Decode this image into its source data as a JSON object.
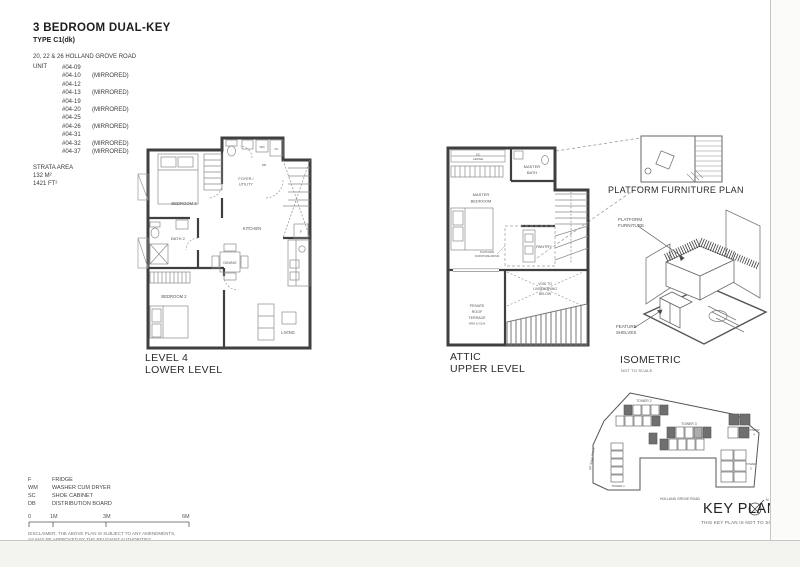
{
  "header": {
    "title": "3 BEDROOM DUAL-KEY",
    "type": "TYPE C1(dk)",
    "address": "20, 22 & 26 HOLLAND GROVE ROAD",
    "unit_label": "UNIT",
    "units": [
      {
        "no": "#04-09",
        "tag": ""
      },
      {
        "no": "#04-10",
        "tag": "(MIRRORED)"
      },
      {
        "no": "#04-12",
        "tag": ""
      },
      {
        "no": "#04-13",
        "tag": "(MIRRORED)"
      },
      {
        "no": "#04-19",
        "tag": ""
      },
      {
        "no": "#04-20",
        "tag": "(MIRRORED)"
      },
      {
        "no": "#04-25",
        "tag": ""
      },
      {
        "no": "#04-26",
        "tag": "(MIRRORED)"
      },
      {
        "no": "#04-31",
        "tag": ""
      },
      {
        "no": "#04-32",
        "tag": "(MIRRORED)"
      },
      {
        "no": "#04-37",
        "tag": "(MIRRORED)"
      }
    ],
    "strata_label": "STRATA AREA",
    "strata_m": "132 M²",
    "strata_ft": "1421 FT²"
  },
  "lower": {
    "caption": [
      "LEVEL 4",
      "LOWER LEVEL"
    ],
    "rooms": {
      "bedroom3": "BEDROOM 3",
      "foyer": [
        "FOYER /",
        "UTILITY"
      ],
      "kitchen": "KITCHEN",
      "bath2": "BATH 2",
      "dining": "DINING",
      "bedroom2": "BEDROOM 2",
      "living": "LIVING"
    },
    "markers": {
      "f": "F",
      "wm": "WM",
      "sc": "SC",
      "db": "DB"
    }
  },
  "attic": {
    "caption": [
      "ATTIC",
      "UPPER LEVEL"
    ],
    "rooms": {
      "ac_ledge": [
        "AC",
        "LEDGE"
      ],
      "master_bath": [
        "MASTER",
        "BATH"
      ],
      "master_bedroom": [
        "MASTER",
        "BEDROOM"
      ],
      "pantry": "PANTRY",
      "platform_note": [
        "PLATFORM",
        "FURNITURE ABOVE"
      ],
      "void": [
        "VOID TO",
        "LIVING/DINING",
        "BELOW"
      ],
      "terrace": [
        "PRIVATE",
        "ROOF",
        "TERRACE"
      ],
      "terrace_area": "AREA 10 SQ M"
    }
  },
  "furniture_plan": {
    "caption": "PLATFORM FURNITURE PLAN"
  },
  "isometric": {
    "caption": "ISOMETRIC",
    "note": "NOT TO SCALE",
    "labels": {
      "platform": [
        "PLATFORM",
        "FURNITURE"
      ],
      "shelves": [
        "FEATURE",
        "SHELVES"
      ]
    }
  },
  "keyplan": {
    "caption": "KEY PLAN",
    "note": "THIS KEY PLAN IS NOT TO SCALE",
    "towers": {
      "t1": "TOWER 1",
      "t2": "TOWER 2",
      "t3": "TOWER 3",
      "t4": [
        "TOWER",
        "4"
      ],
      "t5": [
        "TOWER",
        "5"
      ]
    },
    "roads": {
      "left": "MT SINAI DRIVE",
      "bottom": "HOLLAND GROVE ROAD"
    },
    "compass_n": "N"
  },
  "legend": {
    "items": [
      {
        "abbr": "F",
        "label": "FRIDGE"
      },
      {
        "abbr": "WM",
        "label": "WASHER CUM DRYER"
      },
      {
        "abbr": "SC",
        "label": "SHOE CABINET"
      },
      {
        "abbr": "DB",
        "label": "DISTRIBUTION BOARD"
      }
    ],
    "scale": [
      "0",
      "1M",
      "3M",
      "6M"
    ],
    "disclaimer": [
      "DISCLAIMER: THE ABOVE PLAN IS SUBJECT TO ANY AMENDMENTS,",
      "AS MAY BE APPROVED BY THE RELEVANT AUTHORITIES."
    ]
  },
  "colors": {
    "ink": "#3f3f3f",
    "line": "#8a8a8a",
    "shade": "#6f6f6f"
  }
}
